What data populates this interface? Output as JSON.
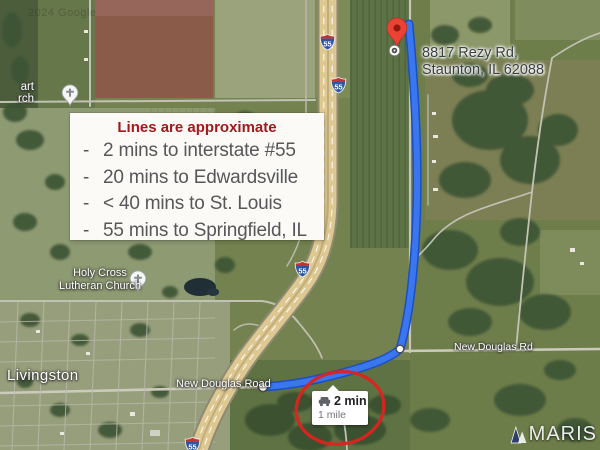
{
  "watermarks": {
    "google": "2024 Google",
    "maris": "MARIS"
  },
  "destination": {
    "address_line1": "8817 Rezy Rd,",
    "address_line2": "Staunton, IL 62088"
  },
  "info_box": {
    "title": "Lines are approximate",
    "bullet": "-",
    "items": [
      "2 mins to interstate #55",
      "20 mins to Edwardsville",
      "< 40 mins to St. Louis",
      "55 mins to Springfield, IL"
    ]
  },
  "map_labels": {
    "town": "Livingston",
    "church_line1": "Holy Cross",
    "church_line2": "Lutheran Church",
    "church_partial_line1": "art",
    "church_partial_line2": "rch",
    "road_left": "New Douglas Road",
    "road_right": "New Douglas Rd",
    "interstate": "55"
  },
  "route_tooltip": {
    "duration": "2 min",
    "distance": "1 mile"
  },
  "colors": {
    "route_blue": "#3a77ef",
    "route_casing": "#1c4fc0",
    "pin_red": "#ea4335",
    "annotation_red": "#da2420",
    "info_title_red": "#a2181c",
    "highway_tan": "#ddc892",
    "shield_blue": "#2b56a4",
    "shield_red": "#bf3430"
  }
}
